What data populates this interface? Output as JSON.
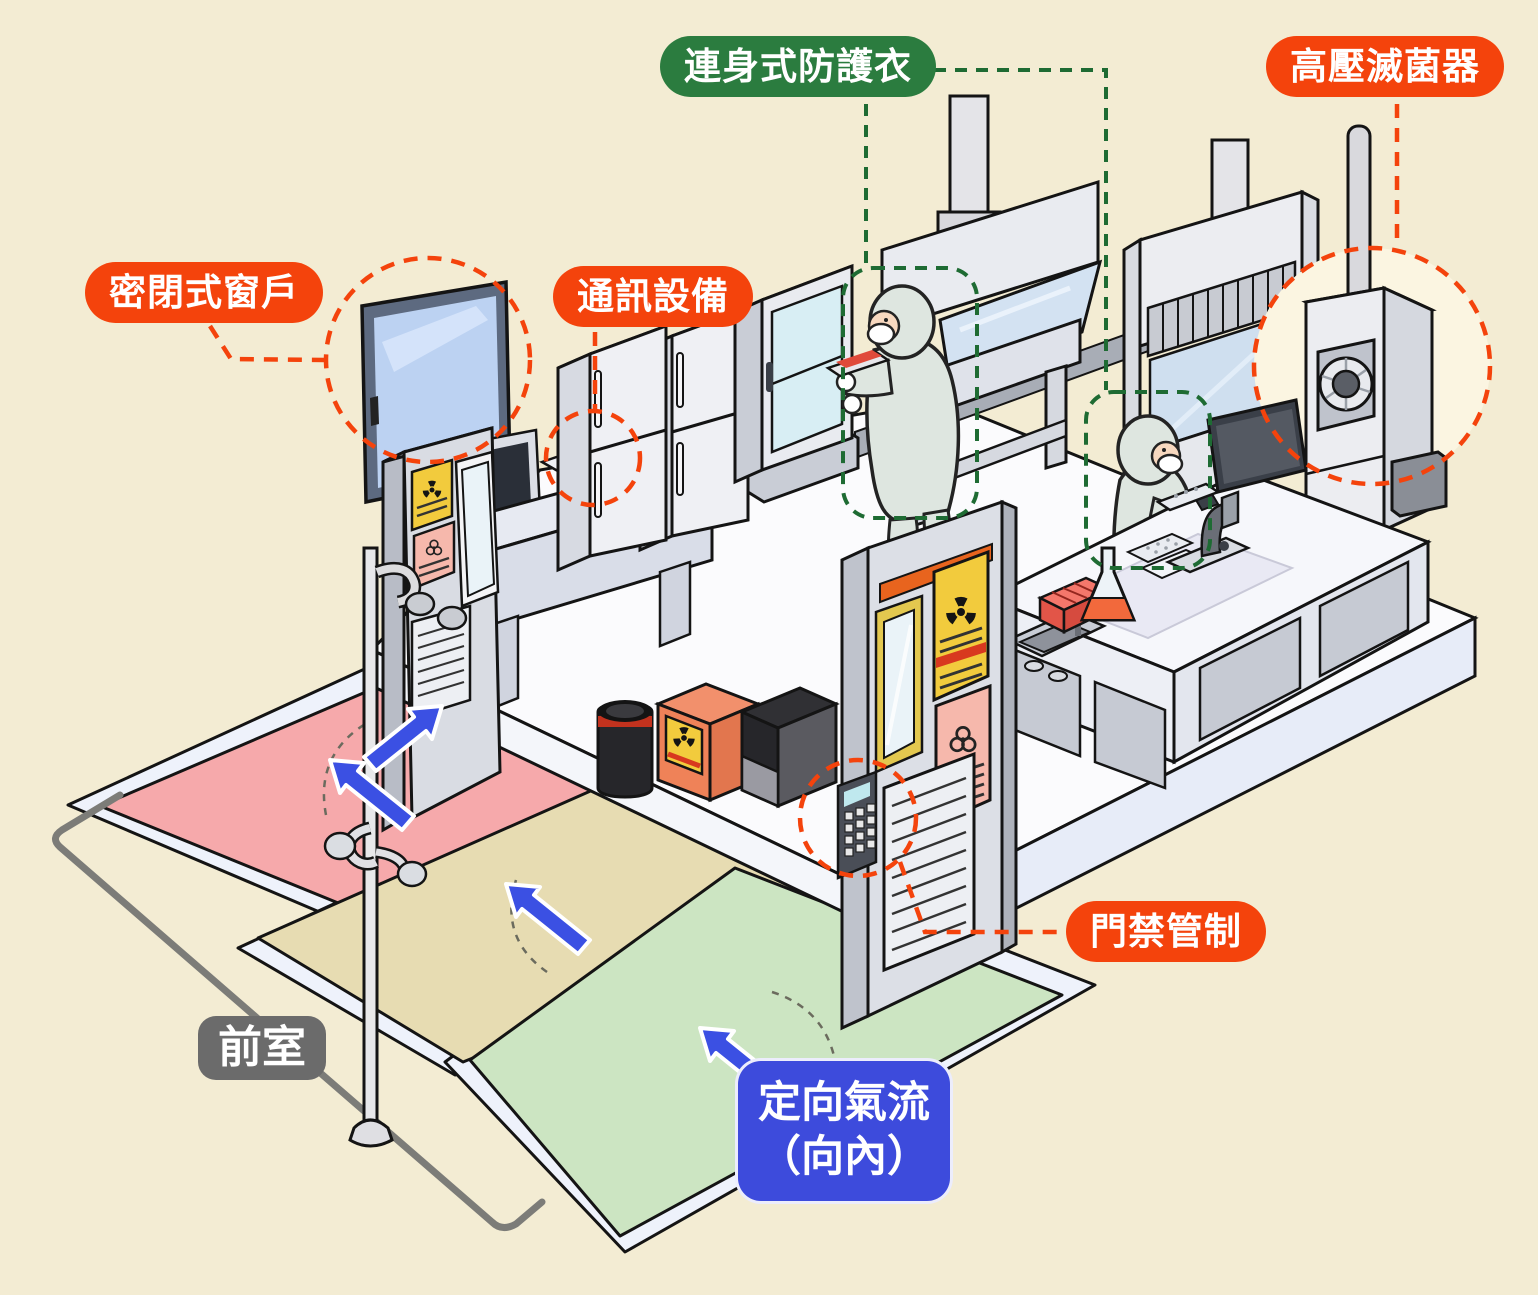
{
  "callouts": {
    "sealed_window": {
      "label": "密閉式窗戶",
      "color": "#F4430C"
    },
    "communication": {
      "label": "通訊設備",
      "color": "#F4430C"
    },
    "protective_suit": {
      "label": "連身式防護衣",
      "color": "#2B7C3F"
    },
    "autoclave": {
      "label": "高壓滅菌器",
      "color": "#F4430C"
    },
    "access_control": {
      "label": "門禁管制",
      "color": "#F4430C"
    },
    "anteroom": {
      "label": "前室",
      "color": "#6B6B6B"
    },
    "directional_airflow": {
      "line1": "定向氣流",
      "line2": "（向內）",
      "color": "#3D4BDC"
    }
  },
  "scene": {
    "background": "#F3ECD3",
    "lab_floor": "#FBFBFD",
    "anteroom_floors": {
      "pink": "#F6A9AB",
      "tan": "#E7DCB2",
      "green": "#CCE5C2"
    },
    "airflow_arrow_color": "#3B50E3",
    "callout_dash_orange": "#F4430C",
    "callout_dash_green": "#1E6B33",
    "hazard_signs": {
      "radiation_sign": "#F2CB3D",
      "biohazard_sign": "#F6B8AC"
    },
    "objects": [
      "sealed-window",
      "telephone",
      "desktop-computer",
      "refrigerator",
      "refrigerator",
      "incubator",
      "biosafety-cabinet",
      "researcher-in-suit",
      "researcher-in-suit",
      "fume-hood",
      "autoclave",
      "lab-bench",
      "sink",
      "erlenmeyer-flask",
      "tube-rack",
      "microscope",
      "monitor",
      "waste-drum",
      "radioactive-waste-box",
      "waste-bin",
      "lab-door",
      "lab-door",
      "keypad",
      "emergency-shower",
      "airflow-arrows"
    ]
  }
}
